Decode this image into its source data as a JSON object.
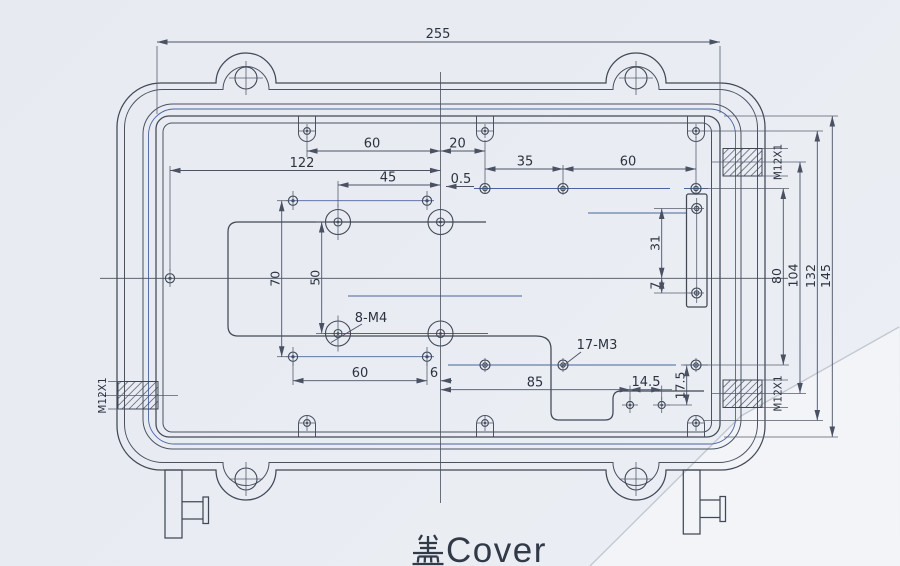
{
  "caption": {
    "full": "盖Cover",
    "cjk": "盖",
    "latin": "Cover"
  },
  "dims": {
    "total_width": "255",
    "top_left_span": "60",
    "top_center_span": "20",
    "left_to_center": "122",
    "mid_left_span": "35",
    "mid_right_span": "60",
    "m4_column_span": "45",
    "center_offset": "0.5",
    "hole_rows_height": "70",
    "m4_rows_height": "50",
    "m4_label": "8-M4",
    "m3_label": "17-M3",
    "bottom_left_span": "60",
    "bottom_center_gap": "6",
    "bottom_mid_span": "85",
    "bottom_step_span": "14.5",
    "step_height": "17.5",
    "slot_upper": "31",
    "slot_lower": "7",
    "right_80": "80",
    "right_104": "104",
    "right_132": "132",
    "right_145": "145",
    "thread_left": "M12X1",
    "thread_top_right": "M12X1",
    "thread_bottom_right": "M12X1"
  },
  "colors": {
    "paper": "#e9edf3",
    "line": "#414856",
    "text": "#2c3340"
  }
}
